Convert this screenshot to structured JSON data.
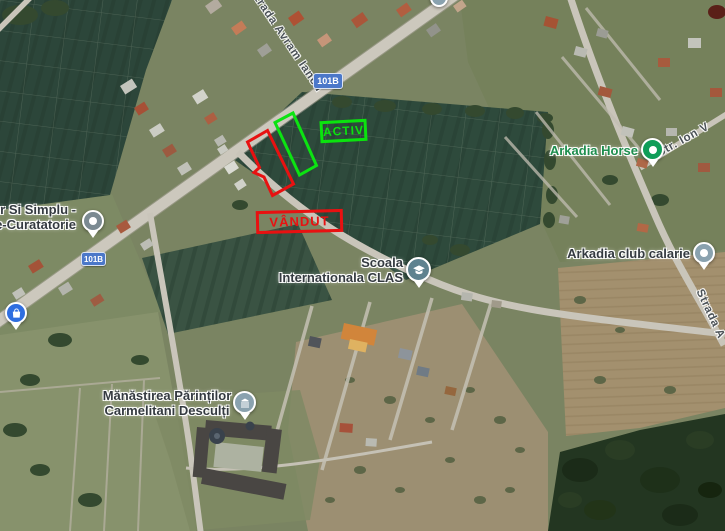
{
  "annotations": {
    "activ": {
      "label": "ACTIV",
      "color": "#0be30e"
    },
    "vandut": {
      "label": "VÂNDUT",
      "color": "#e81111"
    }
  },
  "route_badge": {
    "label": "101B"
  },
  "streets": {
    "main": {
      "label": "Strada Avram Iancu"
    },
    "ion": {
      "label": "Str. Ion V"
    },
    "bottom_right": {
      "label": "Strada A"
    }
  },
  "pois": {
    "curatatorie": {
      "line1": "r Si Simplu -",
      "line2": "e-Curatatorie"
    },
    "arkadia_horse": {
      "label": "Arkadia Horse"
    },
    "arkadia_club": {
      "label": "Arkadia club calarie"
    },
    "scoala": {
      "line1": "Scoala",
      "line2": "Internationala CLAS"
    },
    "manastirea": {
      "line1": "Mănăstirea Părinților",
      "line2": "Carmelitani Desculți"
    }
  },
  "icons": {
    "curatatorie_pin": "gray-dot-pin",
    "shopping_pin": "blue-shopping-bag-pin",
    "arkadia_horse_pin": "green-dot-pin",
    "arkadia_club_pin": "gray-dot-pin",
    "scoala_pin": "graduation-cap-pin",
    "manastirea_pin": "temple-pin",
    "top_edge_pin": "partial-gray-pin"
  },
  "marker_colors": {
    "green": "#0f9d58",
    "blue": "#2f6ee0",
    "gray_blue": "#8aa2af",
    "school": "#5f828f",
    "gray": "#7b8a92"
  }
}
